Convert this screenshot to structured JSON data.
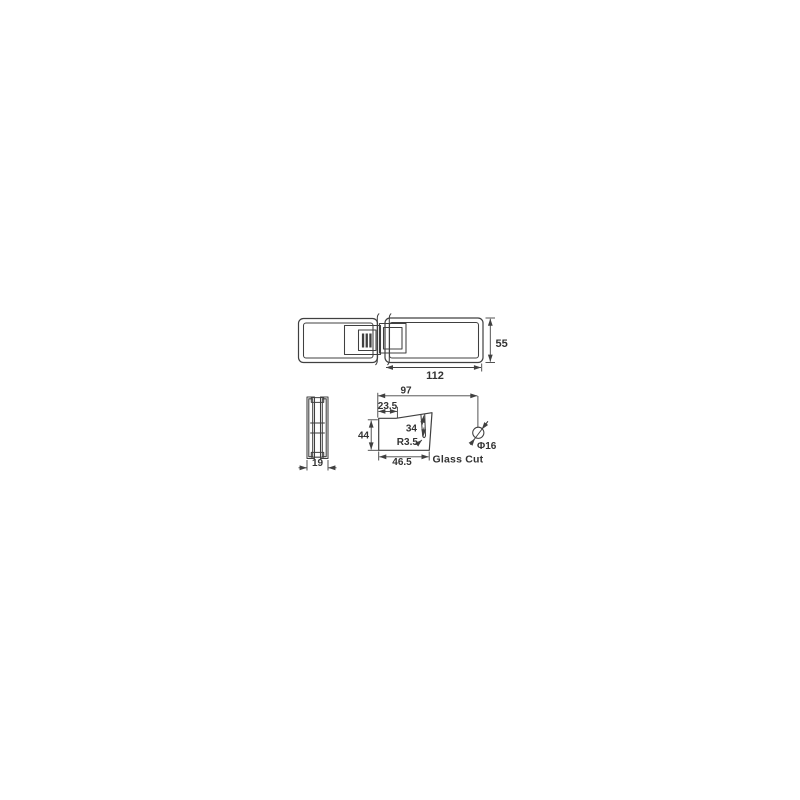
{
  "page": {
    "background_color": "#ffffff"
  },
  "drawing": {
    "colors": {
      "line": "#404040",
      "text": "#333333"
    },
    "assembly_view": {
      "dim_length": "112",
      "dim_height": "55"
    },
    "end_view": {
      "dim_thickness": "19"
    },
    "glass_cut_view": {
      "caption": "Glass Cut",
      "dim_hole_to_edge": "97",
      "dim_notch_offset": "23.5",
      "dim_cut_height": "44",
      "dim_slot_length": "34",
      "dim_slot_radius": "R3.5",
      "dim_cut_width": "46.5",
      "dim_hole_diameter": "Φ16"
    }
  }
}
